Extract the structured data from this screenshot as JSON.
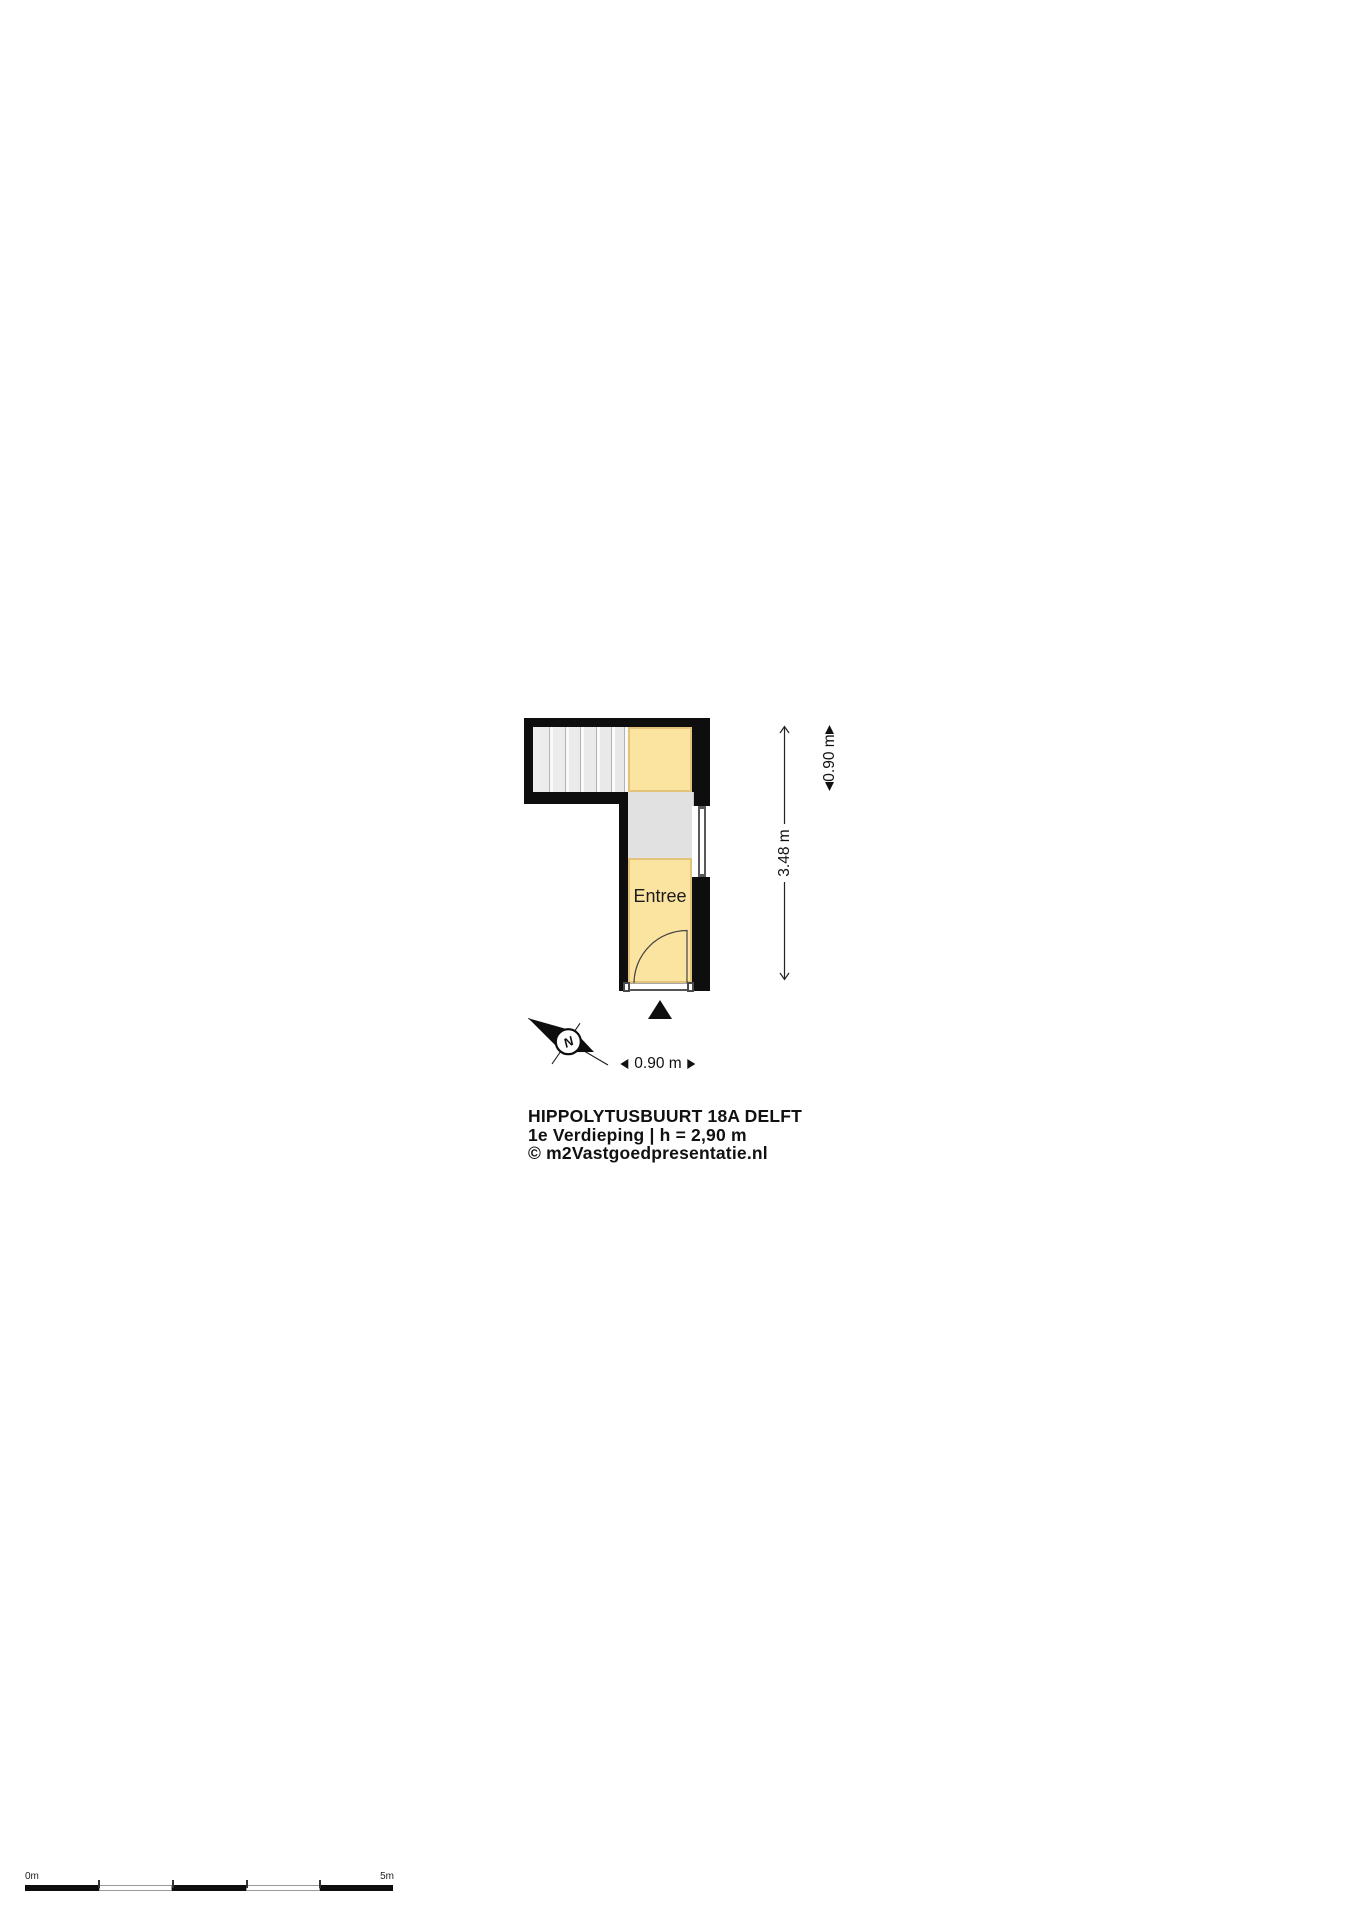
{
  "floor_plan": {
    "room_label": "Entree",
    "compass_north_label": "N"
  },
  "dimensions": {
    "total_height": "3.48 m",
    "top_room_height": "0.90 m",
    "entry_width": "0.90 m"
  },
  "title_block": {
    "address": "HIPPOLYTUSBUURT 18A DELFT",
    "floor_info": "1e Verdieping | h = 2,90 m",
    "copyright": "© m2Vastgoedpresentatie.nl"
  },
  "scale_bar": {
    "start_label": "0m",
    "end_label": "5m",
    "segment_count": 5
  },
  "colors": {
    "wall": "#0e0e0e",
    "room_fill": "#fbe3a0",
    "room_border": "#e3c37a",
    "landing_fill": "#e1e1e1",
    "stairs_fill": "#ededed",
    "ink": "#111111"
  }
}
